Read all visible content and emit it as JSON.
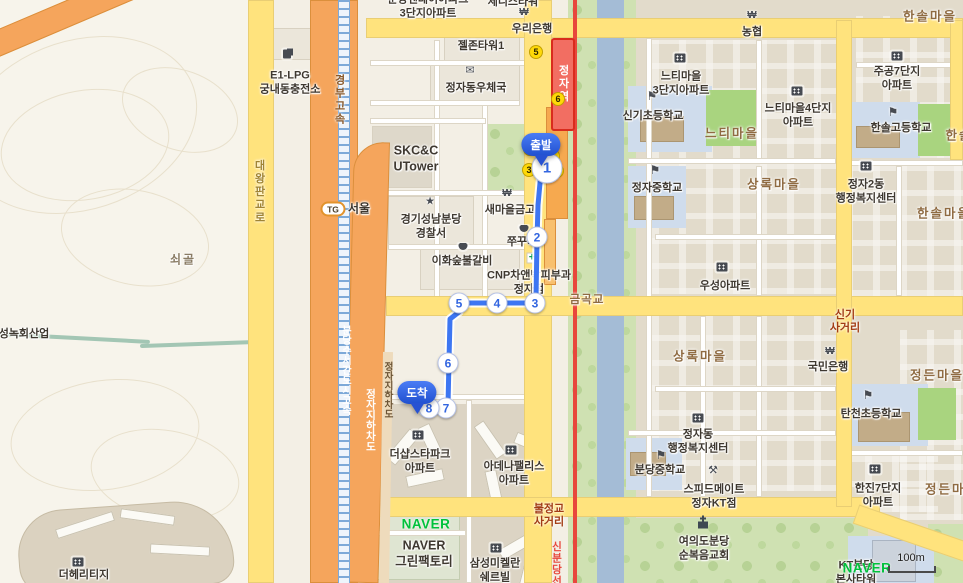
{
  "branding": {
    "watermark": "NAVER",
    "scale_label": "100m"
  },
  "route": {
    "start_label": "출발",
    "dest_label": "도착",
    "start_no": "1",
    "waypoints": [
      "2",
      "3",
      "4",
      "5",
      "6",
      "7",
      "8"
    ]
  },
  "transit": {
    "station": "정자역",
    "line": "신분당선",
    "exits": {
      "e1": "1",
      "e2": "2",
      "e3": "3",
      "e4": "4",
      "e5": "5",
      "e6": "6"
    }
  },
  "roads": {
    "daewang": "대왕판교로",
    "gyeongbu": "경부고속",
    "expwy": "분당수서간도시고속",
    "underpass": "정자지하차도",
    "underpass2": "정자지하차도",
    "tg_badge": "TG",
    "tg_name": "서울",
    "geumgok": "금곡교",
    "singi_x": "신기\n사거리",
    "buljeong_x": "불정교\n사거리"
  },
  "districts": {
    "soegol": "쇠골",
    "hansol1": "한솔마을",
    "hansol2": "한솔마을",
    "hansol3": "한솔",
    "neuti": "느티마을",
    "sangnok1": "상록마을",
    "sangnok2": "상록마을",
    "jeongdeun1": "정든마을",
    "jeongdeun2": "정든마을"
  },
  "pois": {
    "apt_top": "분당센데이아파크\n3단지아파트",
    "tower_top": "세니스타워",
    "woori": "우리은행",
    "geljon": "젤존타워1",
    "e1lpg": "E1-LPG\n궁내동충전소",
    "post": "정자동우체국",
    "skcc": "SKC&C\nUTower",
    "police": "경기성남분당\n경찰서",
    "saemaul": "새마을금고",
    "ihwa": "이화숲불갈비",
    "jjukku": "쭈꾸미",
    "cnp": "CNP차앤박피부과\n정자점",
    "thesharp": "더샵스타파크\n아파트",
    "adena": "아데나팰리스\n아파트",
    "navergf": "NAVER\n그린팩토리",
    "samsung": "삼성미켈란\n쉐르빌",
    "heritage": "더헤리티지",
    "seongnok": "성녹회산업",
    "nonghyup": "농협",
    "neuti3": "느티마을\n3단지아파트",
    "neuti4": "느티마을4단지\n아파트",
    "jugong7": "주공7단지\n아파트",
    "jugong7b": "주공7단지\n아파트",
    "singi_el": "신기초등학교",
    "hansol_hs": "한솔고등학교",
    "jeongja_ms": "정자중학교",
    "jeongja2_cc": "정자2동\n행정복지센터",
    "woosung": "우성아파트",
    "kookmin": "국민은행",
    "tancheon_el": "탄천초등학교",
    "jeongja_cc": "정자동\n행정복지센터",
    "bundang_ms": "분당중학교",
    "speedmate": "스피드메이트\n정자KT점",
    "hanjin7": "한진7단지\n아파트",
    "church": "여의도분당\n순복음교회",
    "kt": "KT분당\n본사타워"
  }
}
